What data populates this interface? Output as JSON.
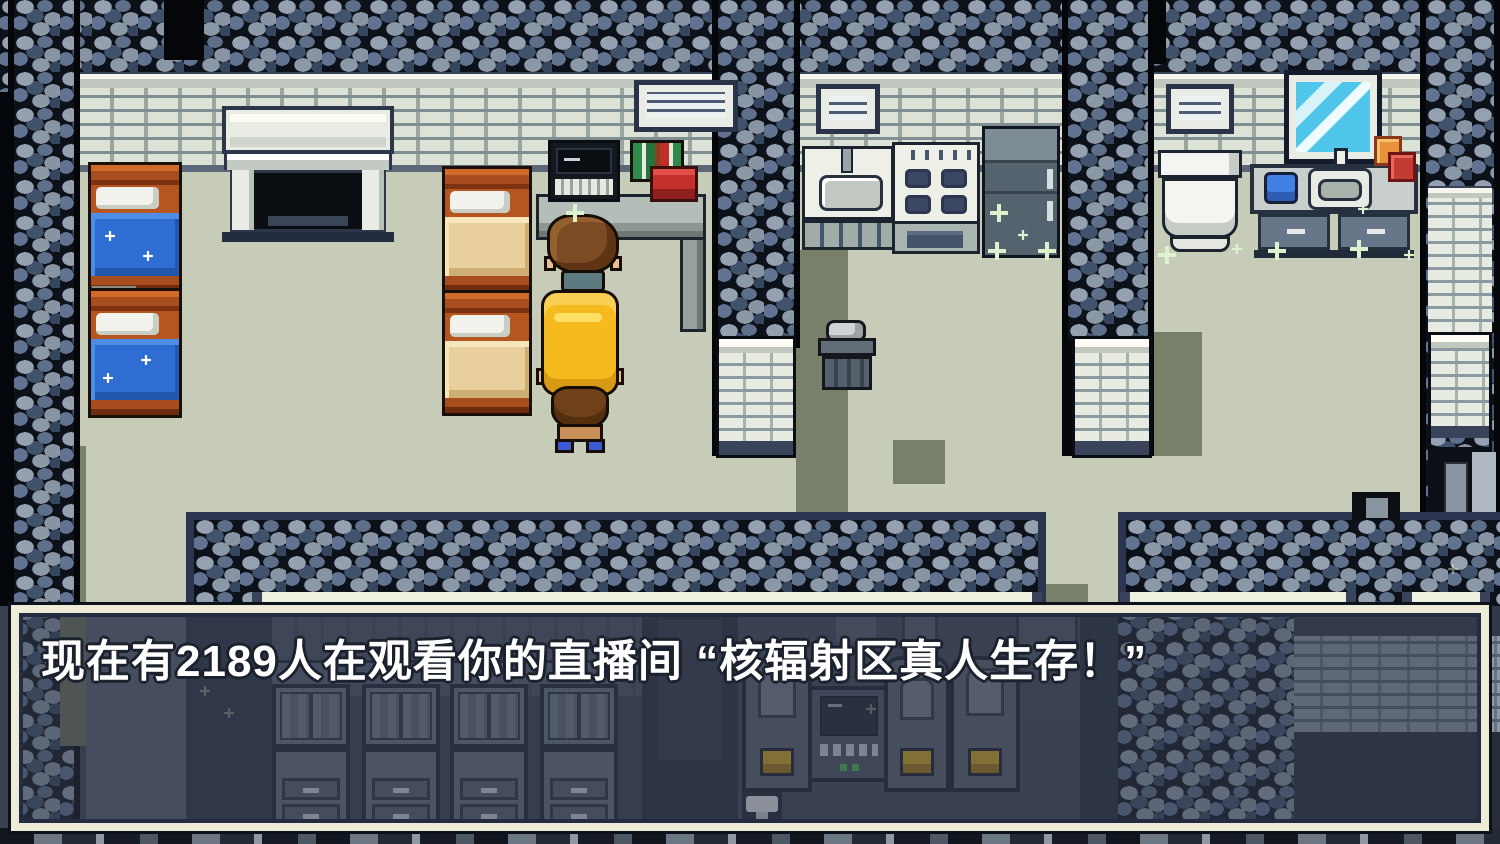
{
  "dialog": {
    "text": "现在有2189人在观看你的直播间 “核辐射区真人生存！”",
    "viewer_count": "2189",
    "stream_title": "核辐射区真人生存！"
  },
  "palette": {
    "floor": "#c6ccb8",
    "wall_brick": "#dde2d6",
    "rock_dark": "#0d1119",
    "rock_light": "#95a1b0",
    "dialog_border_cream": "#eeebd6",
    "dialog_panel": "rgba(52,60,78,0.52)",
    "bed_blue": "#2e6ed2",
    "bed_tan": "#e9cf9c",
    "bed_wood": "#a84e1e",
    "backpack_yellow": "#f4ba1e",
    "mirror_glass": "#4fc6ea",
    "sparkle": "#dff2cf",
    "machine_slot_yellow": "#d8a81c",
    "book_green": "#2e8b4a",
    "box_red": "#c5302c"
  }
}
